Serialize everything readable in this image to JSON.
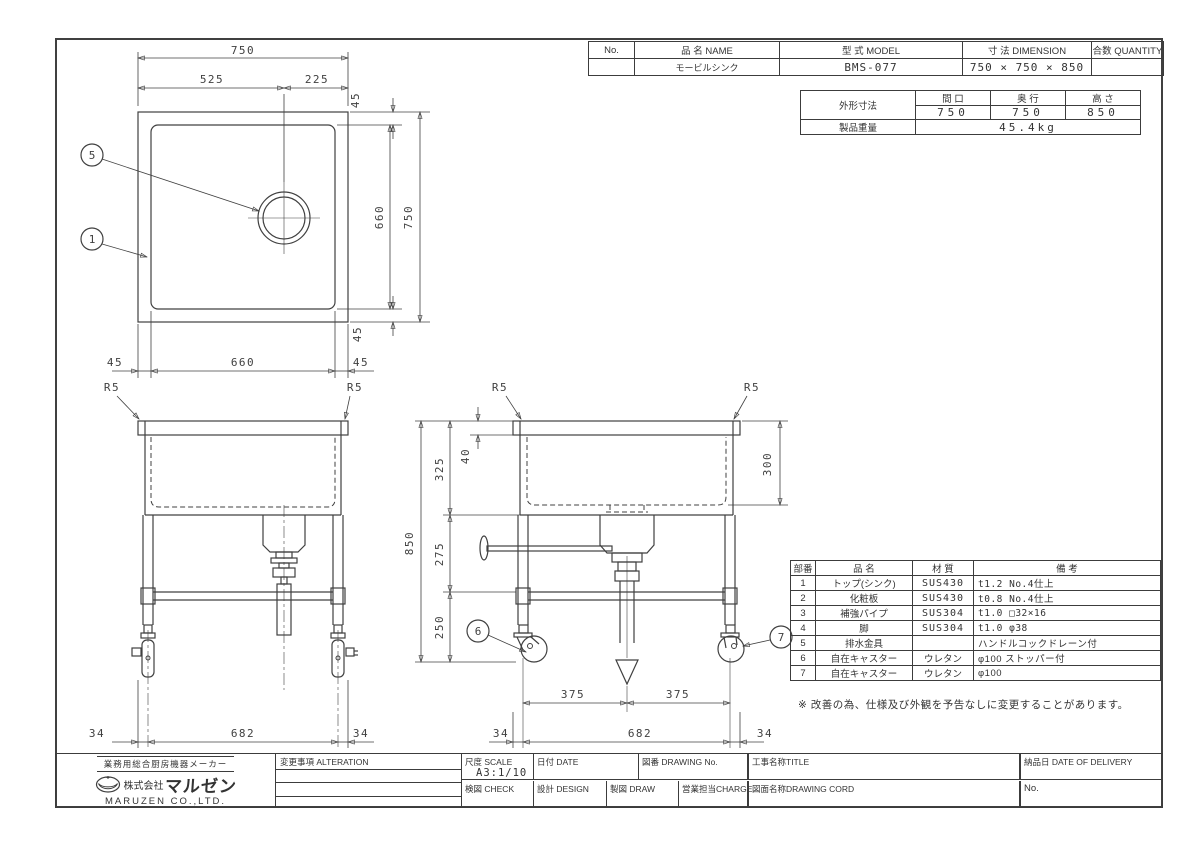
{
  "header": {
    "col_no": "No.",
    "col_name": "品 名  NAME",
    "col_model": "型 式  MODEL",
    "col_dimension": "寸 法  DIMENSION",
    "col_quantity": "合数 QUANTITY",
    "name": "モービルシンク",
    "model": "BMS-077",
    "dimension": "750 × 750 × 850",
    "no": "",
    "quantity": ""
  },
  "spec": {
    "outer_dim_label": "外形寸法",
    "weight_label": "製品重量",
    "col_width": "間 口",
    "col_depth": "奥 行",
    "col_height": "高 さ",
    "width": "750",
    "depth": "750",
    "height": "850",
    "weight": "45.4kg"
  },
  "parts": {
    "col_no": "部番",
    "col_name": "品 名",
    "col_material": "材 質",
    "col_note": "備 考",
    "rows": [
      [
        "1",
        "トップ(シンク)",
        "SUS430",
        "t1.2  No.4仕上"
      ],
      [
        "2",
        "化粧板",
        "SUS430",
        "t0.8  No.4仕上"
      ],
      [
        "3",
        "補強パイプ",
        "SUS304",
        "t1.0  □32×16"
      ],
      [
        "4",
        "脚",
        "SUS304",
        "t1.0  φ38"
      ],
      [
        "5",
        "排水金具",
        "",
        "ハンドルコックドレーン付"
      ],
      [
        "6",
        "自在キャスター",
        "ウレタン",
        "φ100  ストッパー付"
      ],
      [
        "7",
        "自在キャスター",
        "ウレタン",
        "φ100"
      ]
    ]
  },
  "note": "※ 改善の為、仕様及び外観を予告なしに変更することがあります。",
  "title_block": {
    "maker_tagline": "業務用総合厨房機器メーカー",
    "company_prefix": "株式会社",
    "company_logo": "マルゼン",
    "company_en": "MARUZEN CO.,LTD.",
    "alteration_label": "変更事項  ALTERATION",
    "scale_label": "尺度 SCALE",
    "scale_value": "A3:1/10",
    "date_label": "日付 DATE",
    "drawing_no_label": "図番 DRAWING No.",
    "title_label": "工事名称TITLE",
    "delivery_label": "納品日  DATE OF DELIVERY",
    "check_label": "検図 CHECK",
    "design_label": "設計 DESIGN",
    "draw_label": "製図 DRAW",
    "charge_label": "営業担当CHARGE",
    "drawing_cord_label": "図面名称DRAWING CORD",
    "no_label": "No."
  },
  "drawing": {
    "plan": {
      "w_total": "750",
      "w_left": "525",
      "w_right": "225",
      "inset_top": "45",
      "h_inner": "660",
      "h_total": "750",
      "inset_bottom": "45",
      "b_left": "45",
      "b_inner": "660",
      "b_right": "45",
      "balloon_top": "5",
      "balloon_side": "1"
    },
    "front": {
      "r5_left": "R5",
      "r5_right": "R5",
      "b_left": "34",
      "b_center": "682",
      "b_right": "34"
    },
    "side": {
      "r5_left": "R5",
      "r5_right": "R5",
      "rim": "40",
      "seg1": "325",
      "seg2": "275",
      "seg3": "250",
      "h_total": "850",
      "depth": "300",
      "balloon_left": "6",
      "balloon_right": "7",
      "span_left": "375",
      "span_right": "375",
      "b_left": "34",
      "b_center": "682",
      "b_right": "34"
    }
  }
}
